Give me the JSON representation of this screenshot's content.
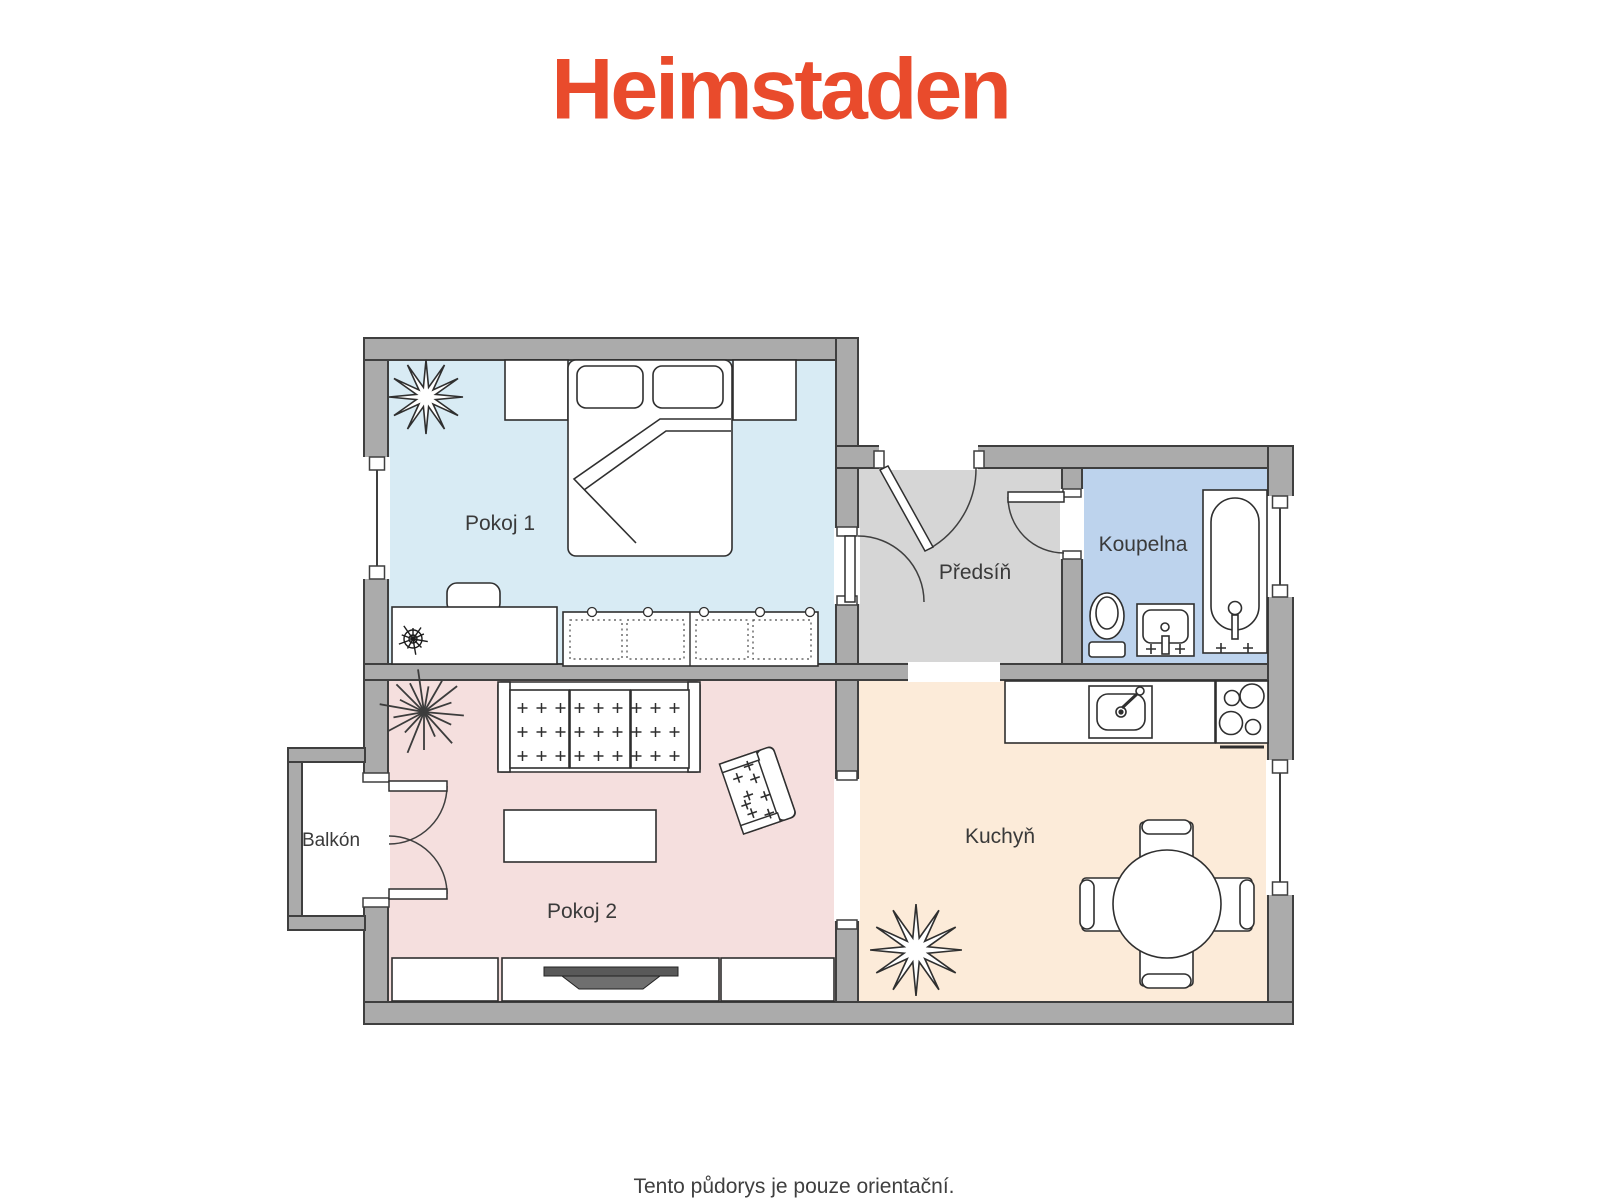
{
  "logo": {
    "text": "Heimstaden",
    "color": "#e94b2c"
  },
  "floorplan": {
    "wall_color": "#ababab",
    "outline_color": "#3f3f3f",
    "rooms": [
      {
        "id": "pokoj-1",
        "label": "Pokoj 1",
        "floor_color": "#d8ebf4"
      },
      {
        "id": "predsin",
        "label": "Předsíň",
        "floor_color": "#d6d6d6"
      },
      {
        "id": "koupelna",
        "label": "Koupelna",
        "floor_color": "#bdd3ed"
      },
      {
        "id": "pokoj-2",
        "label": "Pokoj 2",
        "floor_color": "#f5dfde"
      },
      {
        "id": "kuchyn",
        "label": "Kuchyň",
        "floor_color": "#fcebd9"
      },
      {
        "id": "balkon",
        "label": "Balkón",
        "floor_color": "#ffffff"
      }
    ]
  },
  "footer": {
    "note": "Tento půdorys je pouze orientační."
  }
}
